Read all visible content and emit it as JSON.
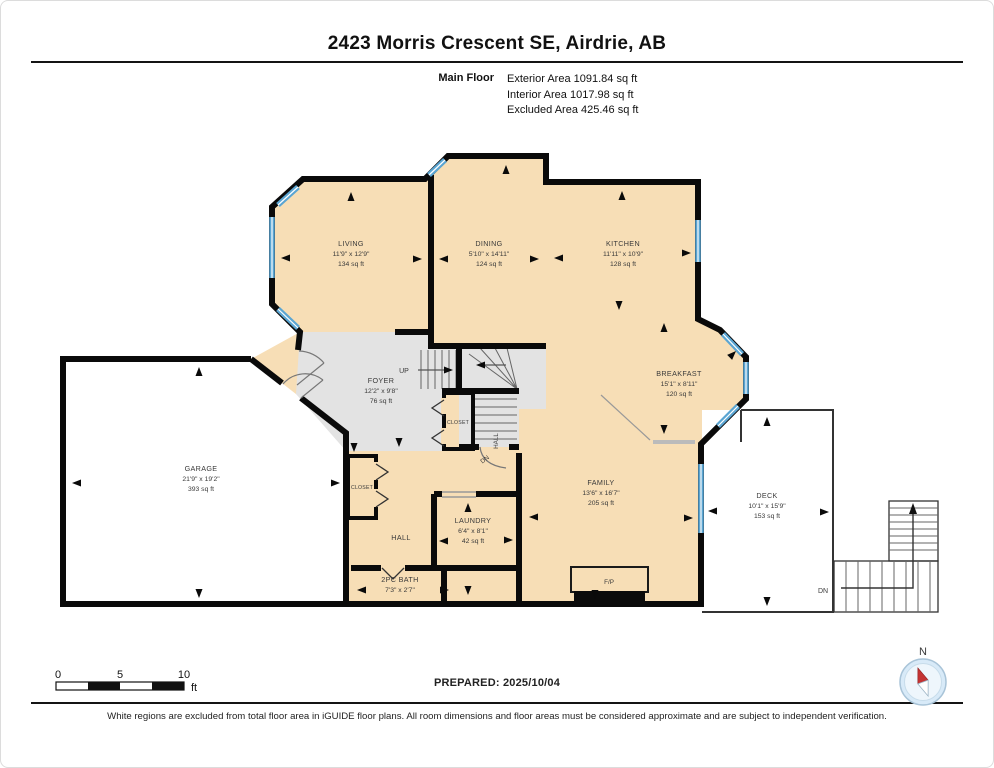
{
  "header": {
    "title": "2423 Morris Crescent SE, Airdrie, AB",
    "floor_label": "Main Floor",
    "areas": [
      "Exterior Area 1091.84 sq ft",
      "Interior Area 1017.98 sq ft",
      "Excluded Area 425.46 sq ft"
    ]
  },
  "plan": {
    "rooms": {
      "living": {
        "name": "LIVING",
        "dims": "11'9\" x 12'9\"",
        "area": "134 sq ft"
      },
      "dining": {
        "name": "DINING",
        "dims": "5'10\" x 14'11\"",
        "area": "124 sq ft"
      },
      "kitchen": {
        "name": "KITCHEN",
        "dims": "11'11\" x 10'9\"",
        "area": "128 sq ft"
      },
      "breakfast": {
        "name": "BREAKFAST",
        "dims": "15'1\" x 8'11\"",
        "area": "120 sq ft"
      },
      "foyer": {
        "name": "FOYER",
        "dims": "12'2\" x 9'8\"",
        "area": "76 sq ft"
      },
      "garage": {
        "name": "GARAGE",
        "dims": "21'9\" x 19'2\"",
        "area": "393 sq ft"
      },
      "family": {
        "name": "FAMILY",
        "dims": "13'6\" x 16'7\"",
        "area": "205 sq ft"
      },
      "laundry": {
        "name": "LAUNDRY",
        "dims": "6'4\" x 8'1\"",
        "area": "42 sq ft"
      },
      "bath": {
        "name": "2PC BATH",
        "dims": "7'3\" x 2'7\""
      },
      "deck": {
        "name": "DECK",
        "dims": "10'1\" x 15'9\"",
        "area": "153 sq ft"
      },
      "hall": {
        "name": "HALL"
      }
    },
    "labels": {
      "up": "UP",
      "dn": "DN",
      "hall_vertical": "HALL",
      "closet": "CLOSET",
      "fireplace": "F/P",
      "deck_dn": "DN"
    },
    "scale_bar": {
      "tick_0": "0",
      "tick_5": "5",
      "tick_10": "10",
      "unit": "ft"
    },
    "compass": {
      "north": "N"
    }
  },
  "footer": {
    "prepared": "PREPARED: 2025/10/04",
    "disclaimer": "White regions are excluded from total floor area in iGUIDE floor plans. All room dimensions and floor areas must be considered approximate and are subject to independent verification."
  },
  "colors": {
    "wall": "#0a0a0a",
    "room_fill": "#f7deb6",
    "excluded_fill": "#e3e3e3",
    "window_blue": "#5aa5d2",
    "compass_red": "#c43333"
  }
}
